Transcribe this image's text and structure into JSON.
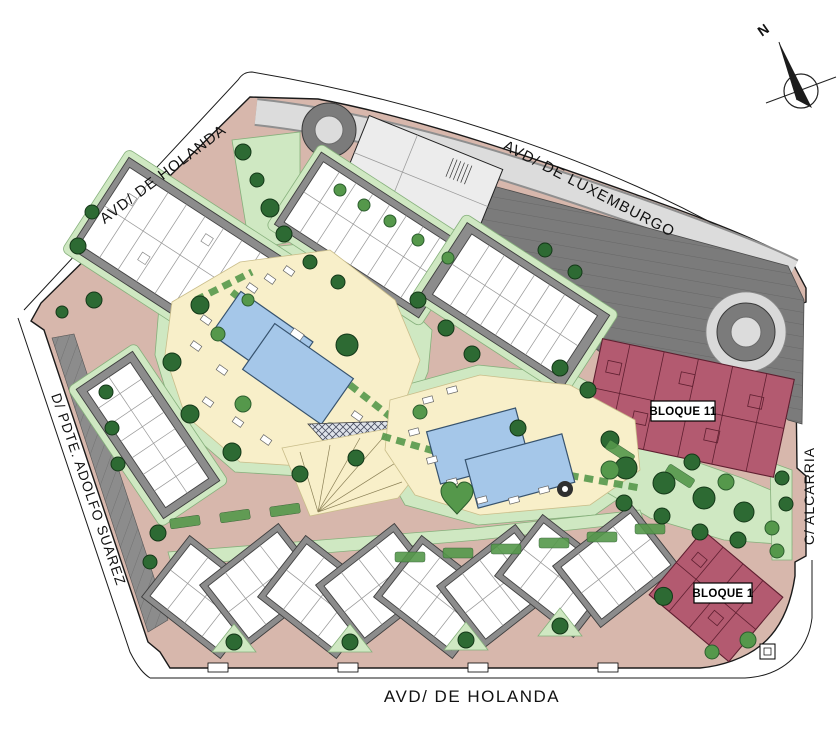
{
  "map": {
    "streets": {
      "top_left": "AVD/ DE HOLANDA",
      "top_right": "AVD/ DE LUXEMBURGO",
      "left": "D/ PDTE. ADOLFO SUAREZ",
      "right": "C/ ALCARRIA",
      "bottom": "AVD/ DE HOLANDA"
    },
    "blocks": {
      "bloque_11": "BLOQUE 11",
      "bloque_1": "BLOQUE 1"
    },
    "compass": {
      "label": "N",
      "icon": "north-arrow-compass"
    },
    "colors": {
      "road": "#d7b7ac",
      "sidewalk": "#dcdcdc",
      "parking": "#7b7b7b",
      "base": "#8c8c8c",
      "bldg": "#ffffff",
      "pale": "#ececec",
      "amenity": "#f8efc9",
      "pool": "#a5c7e9",
      "pooledge": "#37536e",
      "lawn": "#cfe8c2",
      "lawnedge": "#86b07c",
      "treedark": "#2d6a33",
      "treemid": "#55984b",
      "bloque": "#b35a70",
      "bloqueline": "#5f1f30",
      "outline": "#1a1a1a",
      "labelbg": "#ffffff",
      "ink": "#111111"
    }
  }
}
